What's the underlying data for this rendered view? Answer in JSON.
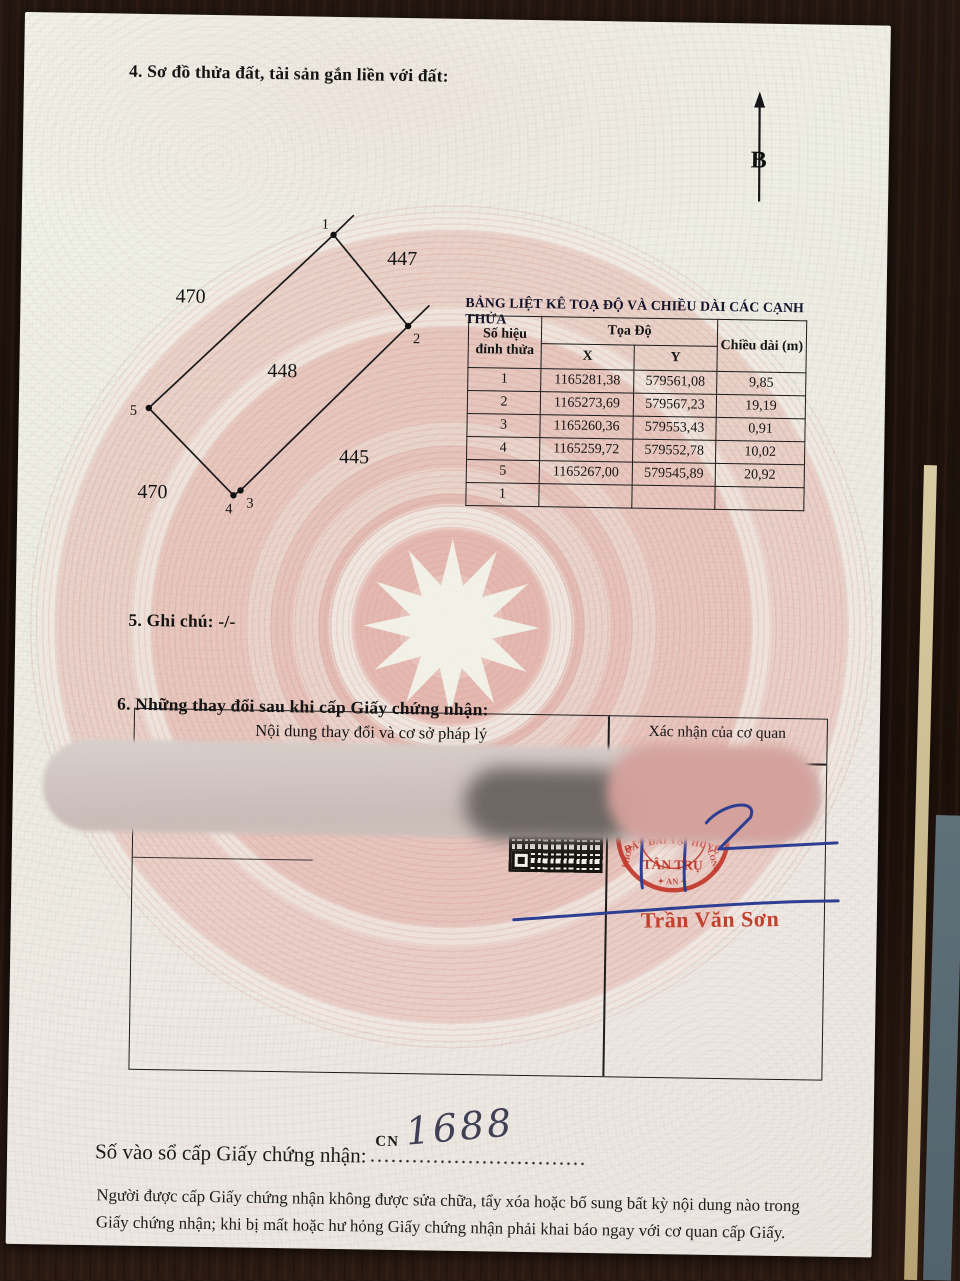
{
  "page": {
    "section4": {
      "title": "4. Sơ đồ thửa đất, tài sản gắn liền với đất:"
    },
    "compass": {
      "label": "B"
    },
    "diagram": {
      "vertices": [
        "1",
        "2",
        "3",
        "4",
        "5"
      ],
      "plots": {
        "top": "447",
        "upper_left": "470",
        "center": "448",
        "lower_right": "445",
        "lower_left": "470"
      }
    },
    "coord_table": {
      "title": "BẢNG LIỆT KÊ TOẠ ĐỘ VÀ CHIỀU DÀI CÁC CẠNH THỬA",
      "headers": {
        "vertex": "Số hiệu đỉnh thửa",
        "coords": "Tọa Độ",
        "x": "X",
        "y": "Y",
        "length": "Chiều dài (m)"
      },
      "rows": [
        {
          "v": "1",
          "x": "1165281,38",
          "y": "579561,08",
          "len": "9,85"
        },
        {
          "v": "2",
          "x": "1165273,69",
          "y": "579567,23",
          "len": "19,19"
        },
        {
          "v": "3",
          "x": "1165260,36",
          "y": "579553,43",
          "len": "0,91"
        },
        {
          "v": "4",
          "x": "1165259,72",
          "y": "579552,78",
          "len": "10,02"
        },
        {
          "v": "5",
          "x": "1165267,00",
          "y": "579545,89",
          "len": "20,92"
        },
        {
          "v": "1",
          "x": "",
          "y": "",
          "len": ""
        }
      ]
    },
    "section5": {
      "title": "5. Ghi chú: -/-"
    },
    "section6": {
      "title": "6. Những thay đổi sau khi cấp Giấy chứng nhận:",
      "col1": "Nội dung thay đổi và cơ sở pháp lý",
      "col2": "Xác nhận của cơ quan"
    },
    "stamp": {
      "arc_top": "ĐẤT ĐAI TẠI HUYỆN",
      "center": "TÂN TRỤ",
      "left": "PHON",
      "right": "LONG",
      "bottom": "✦ AN ✦",
      "color": "#c03b2a"
    },
    "signature": {
      "name": "Trần Văn Sơn",
      "ink": "#2e3f93"
    },
    "registry": {
      "label": "Số vào sổ cấp Giấy chứng nhận:",
      "prefix": "CN",
      "number": "1688"
    },
    "footer": {
      "line1": "Người được cấp Giấy chứng nhận không được sửa chữa, tẩy xóa hoặc bổ sung bất kỳ nội dung nào trong",
      "line2": "Giấy chứng nhận; khi bị mất hoặc hư hỏng Giấy chứng nhận phải khai báo ngay với cơ quan cấp Giấy."
    }
  }
}
